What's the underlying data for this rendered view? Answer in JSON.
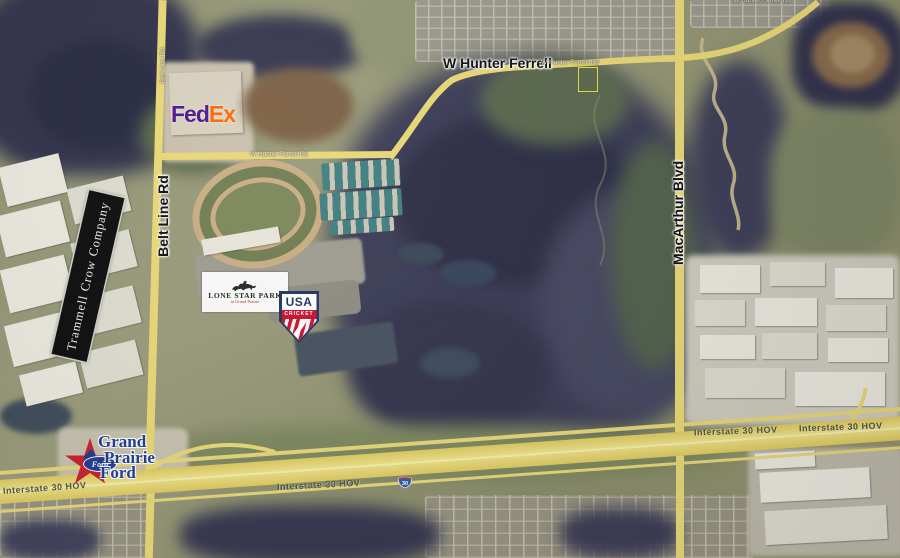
{
  "map_type": "aerial-satellite-marketing-map",
  "roads": {
    "hunter_ferrell_major": "W Hunter Ferrell",
    "hunter_ferrell_minor": "W Hunter Ferrell Rd",
    "belt_line": "Belt Line Rd",
    "macarthur": "MacArthur Blvd",
    "i30_label": "Interstate 30 HOV",
    "i30_shield": "30"
  },
  "logos": {
    "fedex": {
      "part1": "Fed",
      "part2": "Ex",
      "color_purple": "#4D148C",
      "color_orange": "#FF6600"
    },
    "trammell_crow": {
      "name": "Trammell Crow Company",
      "bg": "#0b0b0b",
      "text_color": "#f5f3ee"
    },
    "lone_star_park": {
      "name": "LONE STAR PARK",
      "tagline": "at Grand Prairie",
      "icon": "horse-and-jockey-silhouette",
      "text_color": "#1c2a1e",
      "tagline_color": "#a63a2e"
    },
    "usa_cricket": {
      "line1": "USA",
      "line2": "CRICKET",
      "navy": "#23335e",
      "red": "#c8102e"
    },
    "grand_prairie_ford": {
      "line1": "Grand",
      "line2": "Prairie",
      "line3": "Ford",
      "oval_text": "Ford",
      "star_color": "#c8202c",
      "blue": "#1d3c8f"
    }
  }
}
